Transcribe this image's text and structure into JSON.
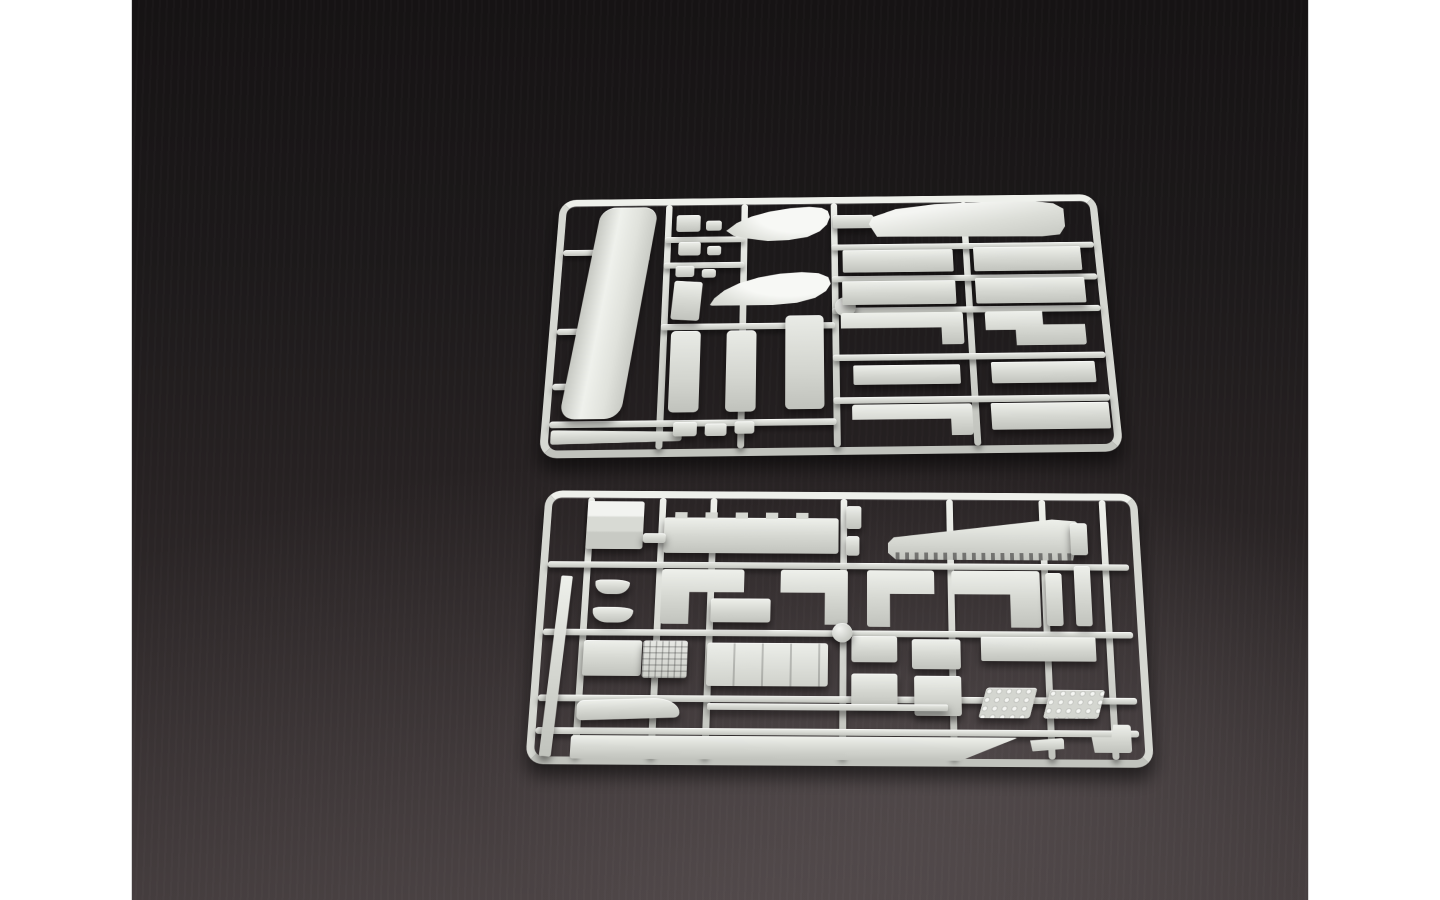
{
  "scene": {
    "description": "Product photograph of two light-gray injection-molded plastic model kit sprues (parts trees) lying on a dark charcoal studio surface, framed by white letterbox bars on the left and right sides.",
    "sprue_count": 2
  },
  "palette": {
    "letterbox": "#ffffff",
    "bg-top": "#161314",
    "bg-bottom": "#3f3839",
    "plastic": "#d6d8d2",
    "plastic-light": "#eef0eb",
    "plastic-dark": "#c1c3bd"
  },
  "photo": {
    "left": 131,
    "top": 0,
    "width": 1178,
    "height": 900
  },
  "sprues": [
    {
      "name": "sprue-top",
      "left": 408,
      "top": 167,
      "width": 585,
      "height": 288,
      "transform": "perspective(650px) rotateX(12deg) rotate(-0.7deg)",
      "runners": [
        [
          116,
          8,
          7,
          272
        ],
        [
          198,
          8,
          7,
          272
        ],
        [
          295,
          8,
          7,
          272
        ],
        [
          436,
          8,
          7,
          272
        ],
        [
          295,
          57,
          282,
          7
        ],
        [
          295,
          94,
          282,
          7
        ],
        [
          295,
          130,
          282,
          7
        ],
        [
          295,
          182,
          282,
          7
        ],
        [
          295,
          228,
          282,
          7
        ],
        [
          8,
          250,
          290,
          7
        ],
        [
          8,
          60,
          42,
          7
        ],
        [
          8,
          150,
          42,
          7
        ],
        [
          8,
          210,
          42,
          7
        ],
        [
          116,
          46,
          86,
          7
        ],
        [
          116,
          76,
          86,
          7
        ],
        [
          116,
          146,
          182,
          7
        ]
      ],
      "parts": [
        [
          46,
          10,
          62,
          238,
          "deckL",
          "skewX(-7deg)"
        ],
        [
          10,
          258,
          132,
          15,
          "wedgeL",
          "rotate(-1deg)"
        ],
        [
          128,
          20,
          26,
          20,
          "rect",
          ""
        ],
        [
          160,
          27,
          17,
          12,
          "rect",
          ""
        ],
        [
          131,
          52,
          24,
          16,
          "rect",
          ""
        ],
        [
          162,
          57,
          15,
          11,
          "rect",
          ""
        ],
        [
          129,
          80,
          20,
          13,
          "rect",
          ""
        ],
        [
          157,
          84,
          15,
          10,
          "rect",
          ""
        ],
        [
          127,
          98,
          30,
          44,
          "rect",
          "rotate(4deg)"
        ],
        [
          127,
          154,
          31,
          88,
          "slab",
          ""
        ],
        [
          185,
          154,
          31,
          88,
          "slab",
          ""
        ],
        [
          246,
          138,
          40,
          102,
          "slab",
          ""
        ],
        [
          133,
          252,
          24,
          15,
          "rect",
          ""
        ],
        [
          165,
          254,
          22,
          13,
          "rect",
          ""
        ],
        [
          195,
          252,
          20,
          13,
          "rect",
          ""
        ],
        [
          182,
          10,
          112,
          42,
          "pontoonA",
          ""
        ],
        [
          166,
          88,
          128,
          38,
          "pontoonB",
          ""
        ],
        [
          298,
          118,
          22,
          22,
          "disc",
          ""
        ],
        [
          297,
          22,
          44,
          16,
          "rect",
          ""
        ],
        [
          336,
          8,
          212,
          42,
          "bigtop",
          ""
        ],
        [
          307,
          64,
          118,
          26,
          "strip",
          ""
        ],
        [
          447,
          62,
          115,
          28,
          "strip",
          ""
        ],
        [
          306,
          100,
          120,
          27,
          "strip",
          ""
        ],
        [
          447,
          98,
          116,
          29,
          "strip",
          ""
        ],
        [
          304,
          136,
          128,
          36,
          "hookR",
          ""
        ],
        [
          455,
          136,
          104,
          38,
          "zpiece",
          ""
        ],
        [
          316,
          194,
          110,
          21,
          "strip",
          ""
        ],
        [
          458,
          192,
          107,
          23,
          "strip",
          ""
        ],
        [
          314,
          236,
          122,
          33,
          "hookR",
          ""
        ],
        [
          455,
          236,
          120,
          28,
          "strip",
          ""
        ]
      ]
    },
    {
      "name": "sprue-bottom",
      "left": 394,
      "top": 470,
      "width": 629,
      "height": 296,
      "transform": "perspective(800px) rotateX(10deg) rotate(0.35deg)",
      "runners": [
        [
          46,
          8,
          7,
          280
        ],
        [
          122,
          8,
          7,
          280
        ],
        [
          176,
          8,
          7,
          280
        ],
        [
          314,
          8,
          7,
          280
        ],
        [
          426,
          8,
          7,
          280
        ],
        [
          524,
          8,
          7,
          280
        ],
        [
          588,
          8,
          7,
          280
        ],
        [
          8,
          80,
          608,
          7
        ],
        [
          8,
          154,
          608,
          7
        ],
        [
          8,
          224,
          608,
          7
        ],
        [
          8,
          258,
          608,
          7
        ]
      ],
      "parts": [
        [
          18,
          96,
          12,
          192,
          "strip",
          "rotate(3deg)"
        ],
        [
          46,
          12,
          60,
          54,
          "box",
          ""
        ],
        [
          128,
          30,
          184,
          40,
          "decktabs",
          ""
        ],
        [
          106,
          48,
          24,
          11,
          "rect",
          ""
        ],
        [
          320,
          16,
          16,
          26,
          "rect",
          ""
        ],
        [
          320,
          50,
          14,
          22,
          "rect",
          ""
        ],
        [
          364,
          30,
          204,
          46,
          "deckteeth",
          ""
        ],
        [
          556,
          34,
          18,
          36,
          "rect",
          ""
        ],
        [
          128,
          88,
          86,
          60,
          "lshapeL",
          ""
        ],
        [
          180,
          120,
          62,
          26,
          "rect",
          ""
        ],
        [
          252,
          88,
          70,
          60,
          "lshapeR",
          ""
        ],
        [
          342,
          88,
          70,
          62,
          "lshapeL",
          ""
        ],
        [
          430,
          88,
          92,
          62,
          "lshapeR",
          ""
        ],
        [
          528,
          90,
          17,
          58,
          "rect",
          ""
        ],
        [
          558,
          82,
          17,
          66,
          "rect",
          ""
        ],
        [
          59,
          100,
          36,
          16,
          "boat",
          ""
        ],
        [
          58,
          130,
          42,
          17,
          "boat",
          ""
        ],
        [
          51,
          166,
          60,
          38,
          "rect",
          ""
        ],
        [
          112,
          166,
          46,
          40,
          "grid",
          ""
        ],
        [
          178,
          168,
          124,
          46,
          "panel",
          ""
        ],
        [
          326,
          160,
          47,
          28,
          "rect",
          ""
        ],
        [
          326,
          200,
          47,
          34,
          "rect",
          ""
        ],
        [
          388,
          163,
          50,
          32,
          "rect",
          ""
        ],
        [
          390,
          202,
          48,
          42,
          "rect",
          ""
        ],
        [
          459,
          160,
          118,
          26,
          "strip",
          ""
        ],
        [
          459,
          214,
          52,
          32,
          "tread",
          ""
        ],
        [
          524,
          216,
          56,
          30,
          "tread",
          ""
        ],
        [
          48,
          228,
          104,
          21,
          "ski",
          ""
        ],
        [
          180,
          232,
          244,
          7,
          "strip",
          ""
        ],
        [
          306,
          146,
          21,
          21,
          "disc",
          ""
        ],
        [
          44,
          266,
          450,
          24,
          "tipstrip",
          ""
        ],
        [
          506,
          266,
          34,
          14,
          "wedge",
          ""
        ],
        [
          568,
          252,
          40,
          29,
          "foot",
          ""
        ]
      ]
    }
  ]
}
